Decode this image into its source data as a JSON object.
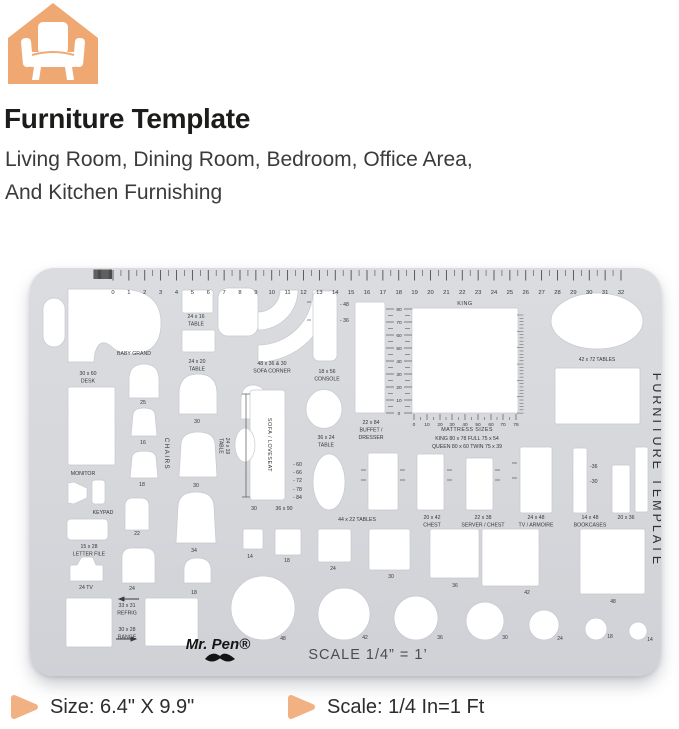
{
  "colors": {
    "accent_orange": "#F0A873",
    "template_gray": "#D7D9DD",
    "text_dark": "#1C1C1B"
  },
  "icons": {
    "logo": "house-armchair-icon",
    "bullet": "arrow-right-bullet-icon"
  },
  "header": {
    "title": "Furniture Template",
    "subtitle_line1": "Living Room, Dining Room, Bedroom, Office Area,",
    "subtitle_line2": "And Kitchen Furnishing"
  },
  "footer": {
    "size_label": "Size: 6.4\" X 9.9\"",
    "scale_label": "Scale: 1/4 In=1 Ft"
  },
  "template": {
    "brand": "Mr. Pen®",
    "scale_text": "SCALE 1/4” = 1’",
    "side_text": "FURNITURE  TEMPLATE",
    "top_ruler": [
      "0",
      "1",
      "2",
      "3",
      "4",
      "5",
      "6",
      "7",
      "8",
      "9",
      "10",
      "11",
      "12",
      "13",
      "14",
      "15",
      "16",
      "17",
      "18",
      "19",
      "20",
      "21",
      "22",
      "23",
      "24",
      "25",
      "26",
      "27",
      "28",
      "29",
      "30",
      "31",
      "32"
    ],
    "height_ruler": [
      "80",
      "70",
      "60",
      "50",
      "40",
      "30",
      "20",
      "10",
      "0"
    ],
    "mattress_ruler": [
      "0",
      "10",
      "20",
      "30",
      "40",
      "50",
      "60",
      "70",
      "78"
    ],
    "squares_row": [
      "14",
      "18",
      "24",
      "30",
      "36",
      "42",
      "48"
    ],
    "circles_row": [
      "48",
      "42",
      "36",
      "30",
      "24",
      "18",
      "14"
    ],
    "labels": [
      {
        "id": "table_24x16",
        "lines": [
          "24 x 16",
          "TABLE"
        ]
      },
      {
        "id": "table_24x20",
        "lines": [
          "24 x 20",
          "TABLE"
        ]
      },
      {
        "id": "baby_grand",
        "lines": [
          "BABY GRAND"
        ]
      },
      {
        "id": "desk_30x60",
        "lines": [
          "30 x 60",
          "DESK"
        ]
      },
      {
        "id": "sofa_corner",
        "lines": [
          "48 x 36 & 30",
          "SOFA  CORNER"
        ]
      },
      {
        "id": "console_18x56",
        "lines": [
          "18 x 56",
          "CONSOLE"
        ]
      },
      {
        "id": "console_mark_48",
        "lines": [
          "- 48"
        ]
      },
      {
        "id": "console_mark_36",
        "lines": [
          "- 36"
        ]
      },
      {
        "id": "king",
        "lines": [
          "KING"
        ]
      },
      {
        "id": "tables_42x72",
        "lines": [
          "42 x 72    TABLES"
        ]
      },
      {
        "id": "buffet_22x84",
        "lines": [
          "22 x 84",
          "BUFFET /",
          "DRESSER"
        ]
      },
      {
        "id": "monitor",
        "lines": [
          "MONITOR"
        ]
      },
      {
        "id": "keypad",
        "lines": [
          "KEYPAD"
        ]
      },
      {
        "id": "letter_file",
        "lines": [
          "15 x 28",
          "LETTER  FILE"
        ]
      },
      {
        "id": "tv_24",
        "lines": [
          "24    TV"
        ]
      },
      {
        "id": "chairs",
        "lines": [
          "CHAIRS"
        ]
      },
      {
        "id": "table_24x19",
        "lines": [
          "24 x 19",
          "TABLE"
        ]
      },
      {
        "id": "chair_25",
        "lines": [
          "25"
        ]
      },
      {
        "id": "chair_16",
        "lines": [
          "16"
        ]
      },
      {
        "id": "chair_18",
        "lines": [
          "18"
        ]
      },
      {
        "id": "chair_22",
        "lines": [
          "22"
        ]
      },
      {
        "id": "chair_24",
        "lines": [
          "24"
        ]
      },
      {
        "id": "chair_30_arch",
        "lines": [
          "30"
        ]
      },
      {
        "id": "chair_30",
        "lines": [
          "30"
        ]
      },
      {
        "id": "chair_34",
        "lines": [
          "34"
        ]
      },
      {
        "id": "chair_18_small",
        "lines": [
          "18"
        ]
      },
      {
        "id": "sofa_loveseat",
        "lines": [
          "SOFA / LOVESEAT"
        ]
      },
      {
        "id": "sofa_mark_60",
        "lines": [
          "- 60"
        ]
      },
      {
        "id": "sofa_mark_66",
        "lines": [
          "- 66"
        ]
      },
      {
        "id": "sofa_mark_72",
        "lines": [
          "- 72"
        ]
      },
      {
        "id": "sofa_mark_78",
        "lines": [
          "- 78"
        ]
      },
      {
        "id": "sofa_mark_84",
        "lines": [
          "- 84"
        ]
      },
      {
        "id": "sofa_30",
        "lines": [
          "30"
        ]
      },
      {
        "id": "sofa_36x90",
        "lines": [
          "36 x 90"
        ]
      },
      {
        "id": "table_36x24",
        "lines": [
          "36 x 24",
          "TABLE"
        ]
      },
      {
        "id": "tables_44x22",
        "lines": [
          "44 x 22   TABLES"
        ]
      },
      {
        "id": "chest_20x42",
        "lines": [
          "20 x 42",
          "CHEST"
        ]
      },
      {
        "id": "server_22x38",
        "lines": [
          "22 x 38",
          "SERVER / CHEST"
        ]
      },
      {
        "id": "tv_armoire_24x48",
        "lines": [
          "24 x 48",
          "TV / ARMOIRE"
        ]
      },
      {
        "id": "bookcases_14x48",
        "lines": [
          "14 x 48",
          "BOOKCASES"
        ]
      },
      {
        "id": "rect_20x36",
        "lines": [
          "20 x 36"
        ]
      },
      {
        "id": "mark_36",
        "lines": [
          "-36"
        ]
      },
      {
        "id": "mark_30",
        "lines": [
          "-30"
        ]
      },
      {
        "id": "mattress_title",
        "lines": [
          "MATTRESS  SIZES"
        ]
      },
      {
        "id": "mattress_row1",
        "lines": [
          "KING   80 x 78       FULL   75 x 54"
        ]
      },
      {
        "id": "mattress_row2",
        "lines": [
          "QUEEN  80 x 60      TWIN   75 x 39"
        ]
      },
      {
        "id": "refrig",
        "lines": [
          "33 x 31",
          "REFRIG"
        ]
      },
      {
        "id": "range",
        "lines": [
          "30 x 28",
          "RANGE"
        ]
      }
    ]
  }
}
